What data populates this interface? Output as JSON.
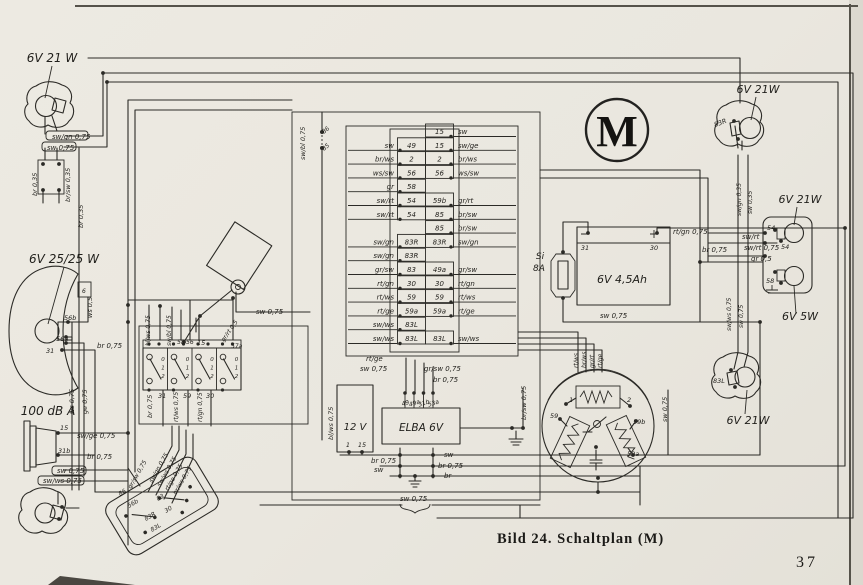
{
  "figure": {
    "caption": "Bild 24. Schaltplan (M)",
    "page_number": "37"
  },
  "motor_mark": "M",
  "colors": {
    "paper": "#eae7df",
    "ink": "#2b2a26",
    "edge_shadow": "#55524a"
  },
  "terminal_block": {
    "rows": [
      {
        "ll": "",
        "lt": "",
        "rt": "15",
        "rl": "sw"
      },
      {
        "ll": "sw",
        "lt": "49",
        "rt": "15",
        "rl": "sw/ge"
      },
      {
        "ll": "br/ws",
        "lt": "2",
        "rt": "2",
        "rl": "br/ws"
      },
      {
        "ll": "ws/sw",
        "lt": "56",
        "rt": "56",
        "rl": "ws/sw"
      },
      {
        "ll": "gr",
        "lt": "58",
        "rt": "",
        "rl": ""
      },
      {
        "ll": "sw/rt",
        "lt": "54",
        "rt": "59b",
        "rl": "gr/rt"
      },
      {
        "ll": "sw/rt",
        "lt": "54",
        "rt": "85",
        "rl": "br/sw"
      },
      {
        "ll": "",
        "lt": "",
        "rt": "85",
        "rl": "br/sw"
      },
      {
        "ll": "sw/gn",
        "lt": "83R",
        "rt": "83R",
        "rl": "sw/gn"
      },
      {
        "ll": "sw/gn",
        "lt": "83R",
        "rt": "",
        "rl": ""
      },
      {
        "ll": "gr/sw",
        "lt": "83",
        "rt": "49a",
        "rl": "gr/sw"
      },
      {
        "ll": "rt/gn",
        "lt": "30",
        "rt": "30",
        "rl": "rt/gn"
      },
      {
        "ll": "rt/ws",
        "lt": "59",
        "rt": "59",
        "rl": "rt/ws"
      },
      {
        "ll": "rt/ge",
        "lt": "59a",
        "rt": "59a",
        "rl": "rt/ge"
      },
      {
        "ll": "sw/ws",
        "lt": "83L",
        "rt": "",
        "rl": ""
      },
      {
        "ll": "sw/ws",
        "lt": "83L",
        "rt": "83L",
        "rl": "sw/ws"
      }
    ]
  },
  "light_switch": {
    "positions": [
      "0",
      "1",
      "2"
    ]
  },
  "elba": {
    "name_label": "ELBA 6V",
    "terminals": [
      "49",
      "49a",
      "31b",
      "53a"
    ]
  },
  "coil_box": {
    "name_label": "12 V",
    "terminals": [
      "1",
      "15"
    ]
  },
  "battery": {
    "name_label": "6V 4,5Ah",
    "terminals": [
      "31",
      "30"
    ]
  },
  "fuse": {
    "line1": "Si",
    "line2": "8A"
  },
  "labels": [
    {
      "n": "front-left-lamp-rating",
      "t": "6V 21 W",
      "x": 52,
      "y": 62,
      "s": 12,
      "a": "m"
    },
    {
      "n": "headlight-rating",
      "t": "6V 25/25 W",
      "x": 64,
      "y": 263,
      "s": 12,
      "a": "m"
    },
    {
      "n": "horn-rating",
      "t": "100 dB A",
      "x": 48,
      "y": 415,
      "s": 12,
      "a": "m"
    },
    {
      "n": "rear-right-top-lamp-rating",
      "t": "6V 21W",
      "x": 758,
      "y": 93,
      "s": 11,
      "a": "m"
    },
    {
      "n": "brake-lamp-rating",
      "t": "6V 21W",
      "x": 800,
      "y": 203,
      "s": 11,
      "a": "m"
    },
    {
      "n": "tail-lamp-rating",
      "t": "6V 5W",
      "x": 800,
      "y": 320,
      "s": 11,
      "a": "m"
    },
    {
      "n": "rear-right-bottom-lamp-rating",
      "t": "6V 21W",
      "x": 748,
      "y": 424,
      "s": 11,
      "a": "m"
    },
    {
      "n": "wire-tag",
      "t": "sw/gn 0,75",
      "x": 52,
      "y": 139,
      "s": 7
    },
    {
      "n": "wire-tag",
      "t": "sw 0,75",
      "x": 47,
      "y": 150,
      "s": 7
    },
    {
      "n": "wire-label",
      "t": "br 0,35",
      "x": 37,
      "y": 196,
      "r": -90,
      "s": 6.5
    },
    {
      "n": "wire-label",
      "t": "br/sw 0,35",
      "x": 70,
      "y": 202,
      "r": -90,
      "s": 6.5
    },
    {
      "n": "wire-label",
      "t": "br 0,35",
      "x": 83,
      "y": 228,
      "r": -90,
      "s": 6.5
    },
    {
      "n": "wire-label",
      "t": "ws 0,5",
      "x": 92,
      "y": 318,
      "r": -90,
      "s": 6.5
    },
    {
      "n": "terminal-label",
      "t": "56b",
      "x": 64,
      "y": 320,
      "s": 6.5
    },
    {
      "n": "terminal-label",
      "t": "56a",
      "x": 56,
      "y": 341,
      "s": 6.5
    },
    {
      "n": "terminal-label",
      "t": "31",
      "x": 46,
      "y": 353,
      "s": 6.5
    },
    {
      "n": "indicator-label",
      "t": "6",
      "x": 82,
      "y": 293,
      "s": 6
    },
    {
      "n": "wire-label",
      "t": "br 0,75",
      "x": 97,
      "y": 348,
      "s": 7
    },
    {
      "n": "wire-label",
      "t": "ws 0,75",
      "x": 74,
      "y": 414,
      "r": -90,
      "s": 6.5
    },
    {
      "n": "wire-label",
      "t": "ge 0,75",
      "x": 87,
      "y": 414,
      "r": -90,
      "s": 6.5
    },
    {
      "n": "terminal-label",
      "t": "15",
      "x": 60,
      "y": 430,
      "s": 6.5
    },
    {
      "n": "wire-label",
      "t": "sw/ge 0,75",
      "x": 77,
      "y": 438,
      "s": 7
    },
    {
      "n": "terminal-label",
      "t": "31b",
      "x": 58,
      "y": 453,
      "s": 6.5
    },
    {
      "n": "wire-label",
      "t": "br 0,75",
      "x": 87,
      "y": 459,
      "s": 7
    },
    {
      "n": "wire-tag",
      "t": "sw 0,75",
      "x": 57,
      "y": 473,
      "s": 7
    },
    {
      "n": "wire-tag",
      "t": "sw/ws 0,75",
      "x": 43,
      "y": 483,
      "s": 7
    },
    {
      "n": "wire-label",
      "t": "sw 0,75",
      "x": 256,
      "y": 314,
      "s": 7
    },
    {
      "n": "wire-label",
      "t": "bl/ws 0,75",
      "x": 150,
      "y": 346,
      "r": -90,
      "s": 6
    },
    {
      "n": "wire-label",
      "t": "sw/bl 0,75",
      "x": 171,
      "y": 346,
      "r": -90,
      "s": 6
    },
    {
      "n": "terminal-label",
      "t": "58",
      "x": 177,
      "y": 344,
      "s": 6
    },
    {
      "n": "terminal-label",
      "t": "56",
      "x": 186,
      "y": 344,
      "s": 6
    },
    {
      "n": "terminal-label",
      "t": "15",
      "x": 197,
      "y": 345,
      "s": 6.5
    },
    {
      "n": "wire-label",
      "t": "gr/rt 0,5",
      "x": 224,
      "y": 342,
      "r": -55,
      "s": 6
    },
    {
      "n": "terminal-label",
      "t": "57a",
      "x": 231,
      "y": 348,
      "s": 6
    },
    {
      "n": "terminal-label",
      "t": "31",
      "x": 158,
      "y": 398,
      "s": 6.5
    },
    {
      "n": "wire-label",
      "t": "br 0,75",
      "x": 152,
      "y": 418,
      "r": -90,
      "s": 6.5
    },
    {
      "n": "terminal-label",
      "t": "59",
      "x": 183,
      "y": 398,
      "s": 6.5
    },
    {
      "n": "wire-label",
      "t": "rt/ws 0,75",
      "x": 178,
      "y": 422,
      "r": -90,
      "s": 6
    },
    {
      "n": "terminal-label",
      "t": "30",
      "x": 206,
      "y": 398,
      "s": 6.5
    },
    {
      "n": "wire-label",
      "t": "rt/gn 0,75",
      "x": 202,
      "y": 422,
      "r": -90,
      "s": 6
    },
    {
      "n": "wire-label",
      "t": "sw/bl 0,75",
      "x": 305,
      "y": 160,
      "r": -90,
      "s": 6.5
    },
    {
      "n": "terminal-label",
      "t": "86",
      "x": 324,
      "y": 134,
      "r": -40,
      "s": 6
    },
    {
      "n": "terminal-label",
      "t": "85",
      "x": 324,
      "y": 151,
      "r": -40,
      "s": 6
    },
    {
      "n": "wire-label",
      "t": "rt/ge",
      "x": 366,
      "y": 361,
      "s": 7
    },
    {
      "n": "wire-label",
      "t": "sw 0,75",
      "x": 360,
      "y": 371,
      "s": 7
    },
    {
      "n": "wire-label",
      "t": "gr/sw 0,75",
      "x": 424,
      "y": 371,
      "s": 7
    },
    {
      "n": "wire-label",
      "t": "br 0,75",
      "x": 433,
      "y": 382,
      "s": 7
    },
    {
      "n": "wire-label",
      "t": "br 0,75",
      "x": 371,
      "y": 463,
      "s": 7
    },
    {
      "n": "wire-label",
      "t": "sw",
      "x": 374,
      "y": 472,
      "s": 7
    },
    {
      "n": "wire-label",
      "t": "sw",
      "x": 444,
      "y": 457,
      "s": 7
    },
    {
      "n": "wire-label",
      "t": "br 0,75",
      "x": 438,
      "y": 468,
      "s": 7
    },
    {
      "n": "wire-label",
      "t": "br",
      "x": 444,
      "y": 478,
      "s": 7
    },
    {
      "n": "wire-label",
      "t": "sw 0,75",
      "x": 400,
      "y": 501,
      "s": 7
    },
    {
      "n": "wire-label",
      "t": "bl/ws 0,75",
      "x": 333,
      "y": 440,
      "r": -90,
      "s": 6.5
    },
    {
      "n": "wire-label",
      "t": "br/sw 0,75",
      "x": 526,
      "y": 420,
      "r": -90,
      "s": 6.5
    },
    {
      "n": "wire-label",
      "t": "rt/gn 0,75",
      "x": 673,
      "y": 234,
      "s": 7
    },
    {
      "n": "wire-label",
      "t": "sw 0,75",
      "x": 600,
      "y": 318,
      "s": 7
    },
    {
      "n": "wire-label",
      "t": "rt/ws",
      "x": 578,
      "y": 368,
      "r": -90,
      "s": 6
    },
    {
      "n": "wire-label",
      "t": "br/ws",
      "x": 586,
      "y": 368,
      "r": -90,
      "s": 6
    },
    {
      "n": "wire-label",
      "t": "gr/rt",
      "x": 594,
      "y": 368,
      "r": -90,
      "s": 6
    },
    {
      "n": "wire-label",
      "t": "rt/ge",
      "x": 602,
      "y": 368,
      "r": -90,
      "s": 6
    },
    {
      "n": "wire-label",
      "t": "sw 0,75",
      "x": 667,
      "y": 422,
      "r": -90,
      "s": 6.5
    },
    {
      "n": "terminal-label",
      "t": "59",
      "x": 550,
      "y": 418,
      "s": 6.5
    },
    {
      "n": "terminal-label",
      "t": "1",
      "x": 569,
      "y": 402,
      "s": 6.5
    },
    {
      "n": "terminal-label",
      "t": "2",
      "x": 627,
      "y": 402,
      "s": 6.5
    },
    {
      "n": "terminal-label",
      "t": "59b",
      "x": 633,
      "y": 424,
      "s": 6.5
    },
    {
      "n": "terminal-label",
      "t": "59a",
      "x": 627,
      "y": 456,
      "s": 6.5
    },
    {
      "n": "terminal-label",
      "t": "83R",
      "x": 715,
      "y": 127,
      "r": -20,
      "s": 6.5
    },
    {
      "n": "wire-label",
      "t": "sw/gn 0,35",
      "x": 741,
      "y": 216,
      "r": -90,
      "s": 6
    },
    {
      "n": "wire-label",
      "t": "sw 0,35",
      "x": 752,
      "y": 214,
      "r": -90,
      "s": 6
    },
    {
      "n": "wire-label",
      "t": "sw/rt",
      "x": 742,
      "y": 239,
      "s": 7
    },
    {
      "n": "wire-label",
      "t": "sw/rt 0,75",
      "x": 744,
      "y": 250,
      "s": 7
    },
    {
      "n": "wire-label",
      "t": "gr 0,5",
      "x": 751,
      "y": 261,
      "s": 7
    },
    {
      "n": "wire-label",
      "t": "br 0,75",
      "x": 702,
      "y": 252,
      "s": 7
    },
    {
      "n": "terminal-label",
      "t": "54",
      "x": 767,
      "y": 230,
      "s": 6.5
    },
    {
      "n": "terminal-label",
      "t": "54",
      "x": 781,
      "y": 249,
      "s": 6.5
    },
    {
      "n": "terminal-label",
      "t": "58",
      "x": 766,
      "y": 283,
      "s": 6.5
    },
    {
      "n": "wire-label",
      "t": "sw/ws 0,75",
      "x": 731,
      "y": 331,
      "r": -90,
      "s": 6
    },
    {
      "n": "wire-label",
      "t": "sw 0,75",
      "x": 743,
      "y": 328,
      "r": -90,
      "s": 6
    },
    {
      "n": "terminal-label",
      "t": "83L",
      "x": 713,
      "y": 383,
      "s": 6.5
    },
    {
      "n": "terminal-label",
      "t": "86",
      "x": 120,
      "y": 496,
      "r": -31,
      "s": 6
    },
    {
      "n": "terminal-label",
      "t": "56b",
      "x": 129,
      "y": 508,
      "r": -31,
      "s": 6
    },
    {
      "n": "terminal-label",
      "t": "83",
      "x": 158,
      "y": 501,
      "r": -31,
      "s": 6
    },
    {
      "n": "terminal-label",
      "t": "83R",
      "x": 146,
      "y": 521,
      "r": -31,
      "s": 6
    },
    {
      "n": "terminal-label",
      "t": "30",
      "x": 166,
      "y": 513,
      "r": -31,
      "s": 6
    },
    {
      "n": "terminal-label",
      "t": "83L",
      "x": 152,
      "y": 532,
      "r": -31,
      "s": 6
    },
    {
      "n": "wire-label",
      "t": "gr/sw 0,75",
      "x": 131,
      "y": 489,
      "r": -60,
      "s": 6
    },
    {
      "n": "wire-label",
      "t": "sw/gn 0,75",
      "x": 152,
      "y": 483,
      "r": -60,
      "s": 6
    },
    {
      "n": "wire-label",
      "t": "sw/ws 0,75",
      "x": 160,
      "y": 487,
      "r": -60,
      "s": 6
    },
    {
      "n": "wire-label",
      "t": "rt/ge 0,75",
      "x": 168,
      "y": 491,
      "r": -60,
      "s": 6
    },
    {
      "n": "wire-label",
      "t": "br/ws 0,75",
      "x": 176,
      "y": 495,
      "r": -60,
      "s": 6
    }
  ]
}
